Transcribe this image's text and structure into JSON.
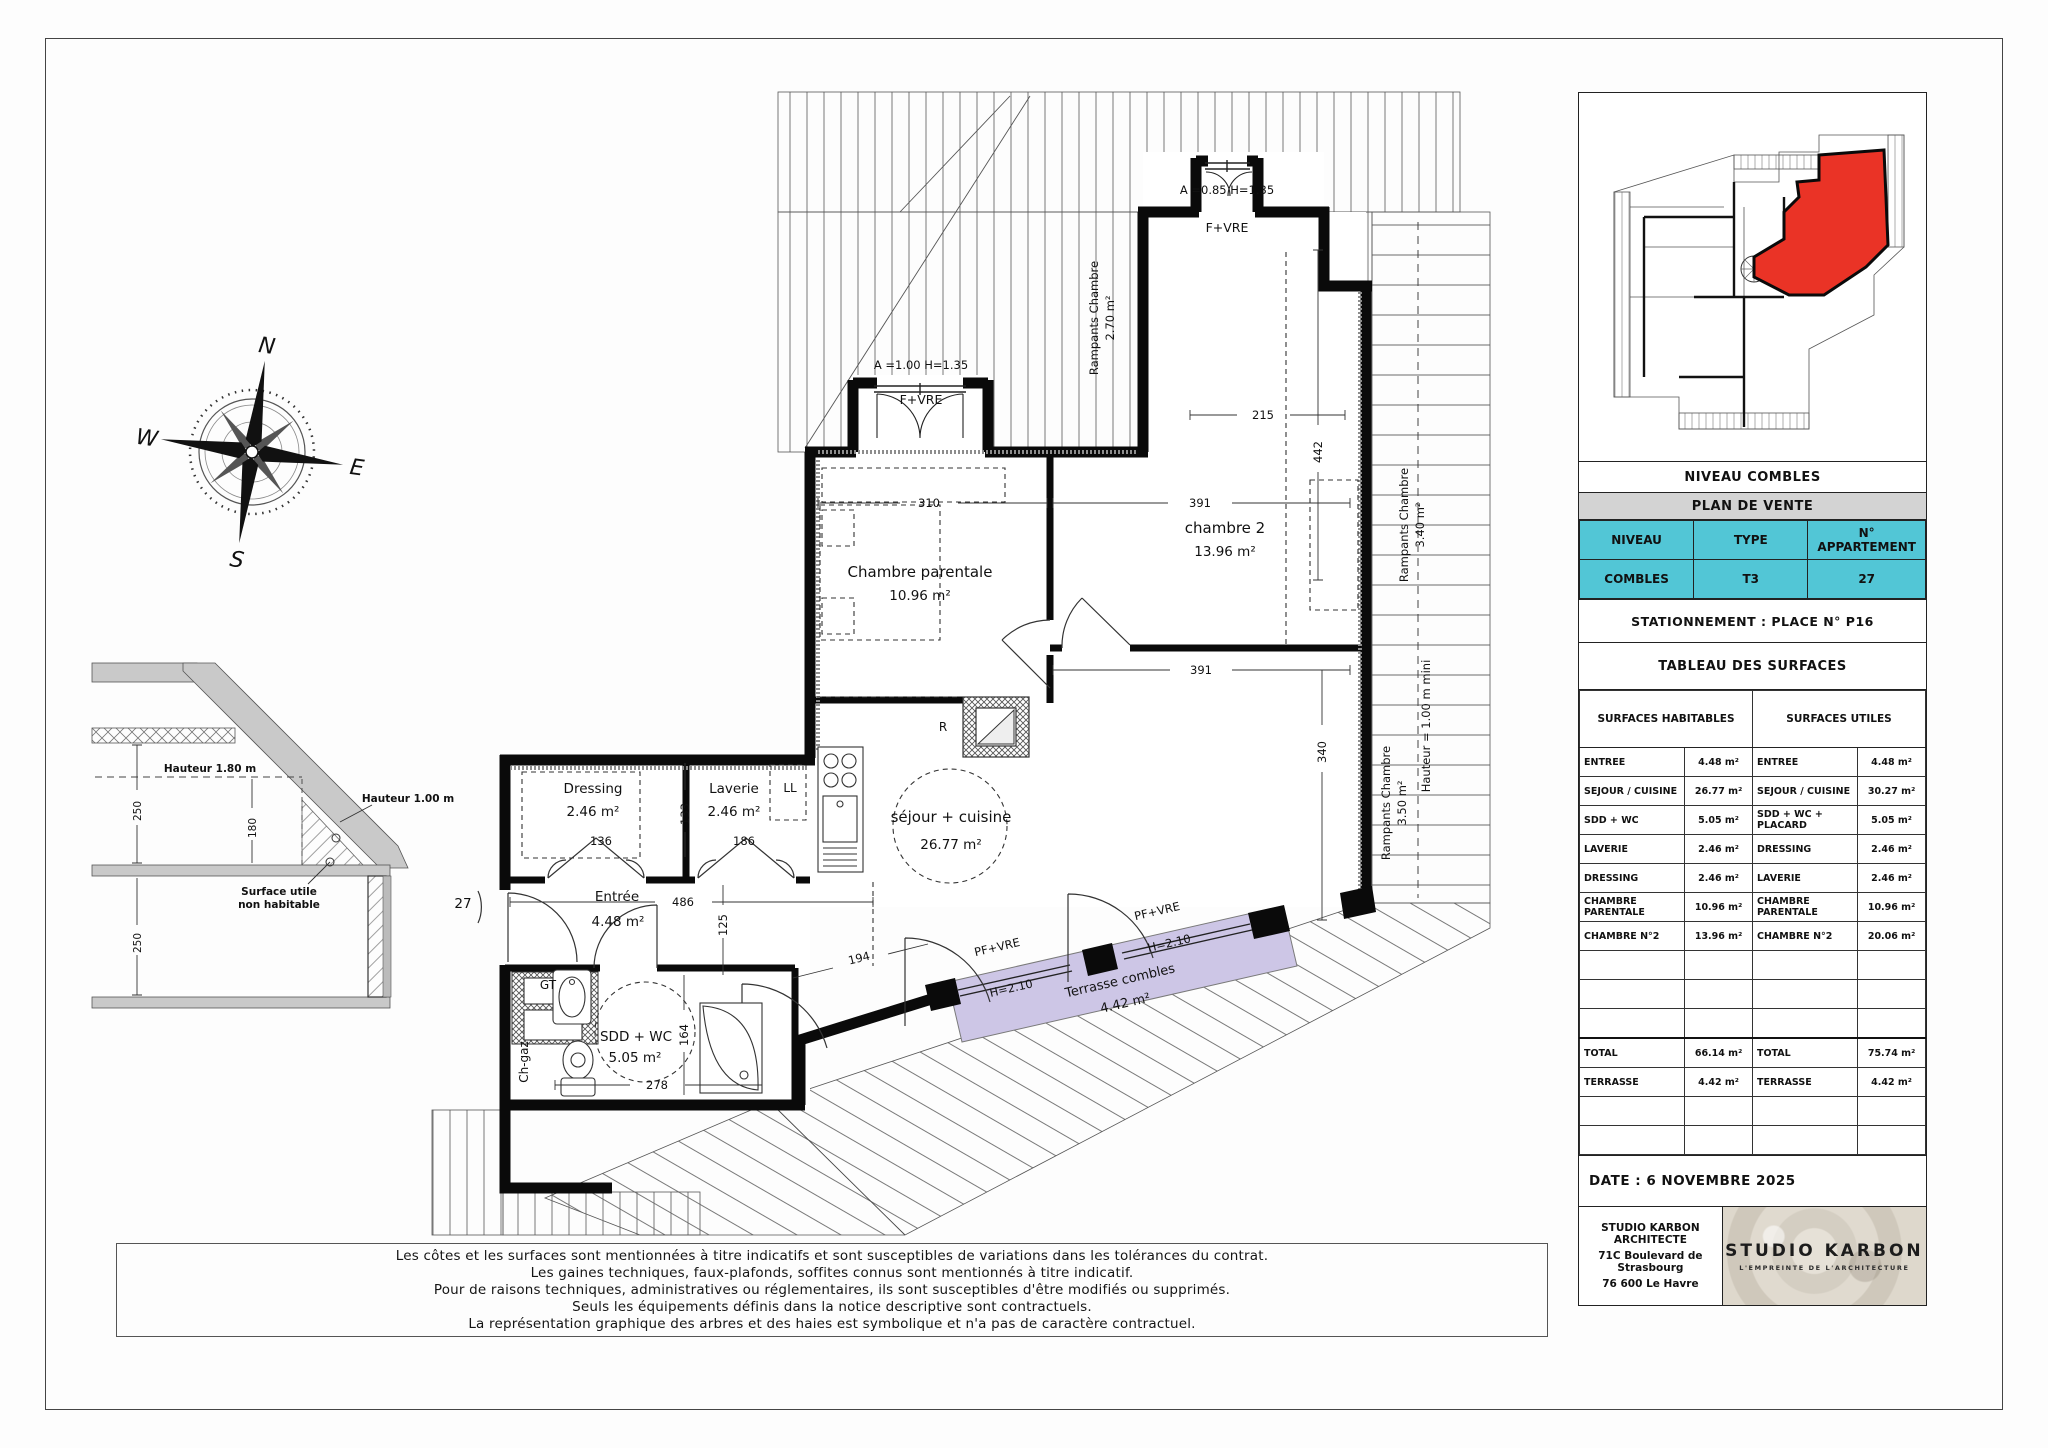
{
  "plan": {
    "rooms": {
      "parentale": {
        "name": "Chambre parentale",
        "area": "10.96 m²"
      },
      "chambre2": {
        "name": "chambre 2",
        "area": "13.96 m²"
      },
      "sejour": {
        "name": "séjour + cuisine",
        "area": "26.77 m²"
      },
      "dressing": {
        "name": "Dressing",
        "area": "2.46 m²"
      },
      "laverie": {
        "name": "Laverie",
        "area": "2.46 m²"
      },
      "entree": {
        "name": "Entrée",
        "area": "4.48 m²"
      },
      "sdd": {
        "name": "SDD + WC",
        "area": "5.05 m²"
      },
      "terrasse": {
        "name": "Terrasse combles",
        "area": "4.42 m²"
      }
    },
    "labels": {
      "f_vre": "F+VRE",
      "pf_vre": "PF+VRE",
      "h210": "H=2.10",
      "a100": "A =1.00 H=1.35",
      "a085": "A =0.85 H=1.35",
      "r": "R",
      "ll": "LL",
      "gt": "GT",
      "chgaz": "Ch-gaz",
      "door": "27",
      "rampants": "Rampants Chambre",
      "r270": "2.70 m²",
      "r340": "3.40 m²",
      "r350": "3.50 m²",
      "hmini": "Hauteur = 1.00 m mini"
    },
    "dims": {
      "d310": "310",
      "d391": "391",
      "d215": "215",
      "d442": "442",
      "d340": "340",
      "d486": "486",
      "d125": "125",
      "d133": "133",
      "d136": "136",
      "d186": "186",
      "d164": "164",
      "d278": "278",
      "d194": "194"
    }
  },
  "compass": {
    "n": "N",
    "e": "E",
    "s": "S",
    "w": "W"
  },
  "section": {
    "h180": "Hauteur 1.80 m",
    "h100": "Hauteur 1.00 m",
    "note1": "Surface utile",
    "note2": "non habitable",
    "d250a": "250",
    "d180": "180",
    "d250b": "250"
  },
  "title_block": {
    "niveau_title": "NIVEAU COMBLES",
    "plan_title": "PLAN DE VENTE",
    "headers": {
      "niveau": "NIVEAU",
      "type": "TYPE",
      "apartment": "N° APPARTEMENT"
    },
    "values": {
      "niveau": "COMBLES",
      "type": "T3",
      "apartment": "27"
    },
    "stationnement": "STATIONNEMENT : PLACE N° P16",
    "tableau_title": "TABLEAU DES SURFACES",
    "col_habitables": "SURFACES HABITABLES",
    "col_utiles": "SURFACES UTILES",
    "habitables": [
      {
        "label": "ENTREE",
        "value": "4.48 m²"
      },
      {
        "label": "SEJOUR / CUISINE",
        "value": "26.77 m²"
      },
      {
        "label": "SDD + WC",
        "value": "5.05 m²"
      },
      {
        "label": "LAVERIE",
        "value": "2.46 m²"
      },
      {
        "label": "DRESSING",
        "value": "2.46 m²"
      },
      {
        "label": "CHAMBRE PARENTALE",
        "value": "10.96 m²"
      },
      {
        "label": "CHAMBRE N°2",
        "value": "13.96 m²"
      }
    ],
    "utiles": [
      {
        "label": "ENTREE",
        "value": "4.48 m²"
      },
      {
        "label": "SEJOUR / CUISINE",
        "value": "30.27 m²"
      },
      {
        "label": "SDD + WC + PLACARD",
        "value": "5.05 m²"
      },
      {
        "label": "DRESSING",
        "value": "2.46 m²"
      },
      {
        "label": "LAVERIE",
        "value": "2.46 m²"
      },
      {
        "label": "CHAMBRE PARENTALE",
        "value": "10.96 m²"
      },
      {
        "label": "CHAMBRE N°2",
        "value": "20.06 m²"
      }
    ],
    "total_label": "TOTAL",
    "habitables_total": "66.14 m²",
    "utiles_total": "75.74 m²",
    "terrasse_label": "TERRASSE",
    "habitables_terrasse": "4.42 m²",
    "utiles_terrasse": "4.42 m²",
    "date": "DATE : 6 NOVEMBRE 2025",
    "architect": {
      "line1": "STUDIO KARBON ARCHITECTE",
      "line2": "71C Boulevard de Strasbourg",
      "line3": "76 600 Le Havre"
    },
    "logo": {
      "name": "STUDIO KARBON",
      "tagline": "L'EMPREINTE DE L'ARCHITECTURE"
    }
  },
  "disclaimer": {
    "line1": "Les côtes et les surfaces sont mentionnées à titre indicatifs et sont susceptibles de variations dans les tolérances du contrat.",
    "line2": "Les gaines techniques, faux-plafonds, soffites connus sont mentionnés à titre indicatif.",
    "line3": "Pour de raisons techniques, administratives ou réglementaires, ils sont susceptibles d'être modifiés ou supprimés.",
    "line4": "Seuls les équipements définis dans la notice descriptive sont contractuels.",
    "line5": "La représentation graphique  des arbres et des haies est symbolique et n'a pas de caractère contractuel."
  }
}
